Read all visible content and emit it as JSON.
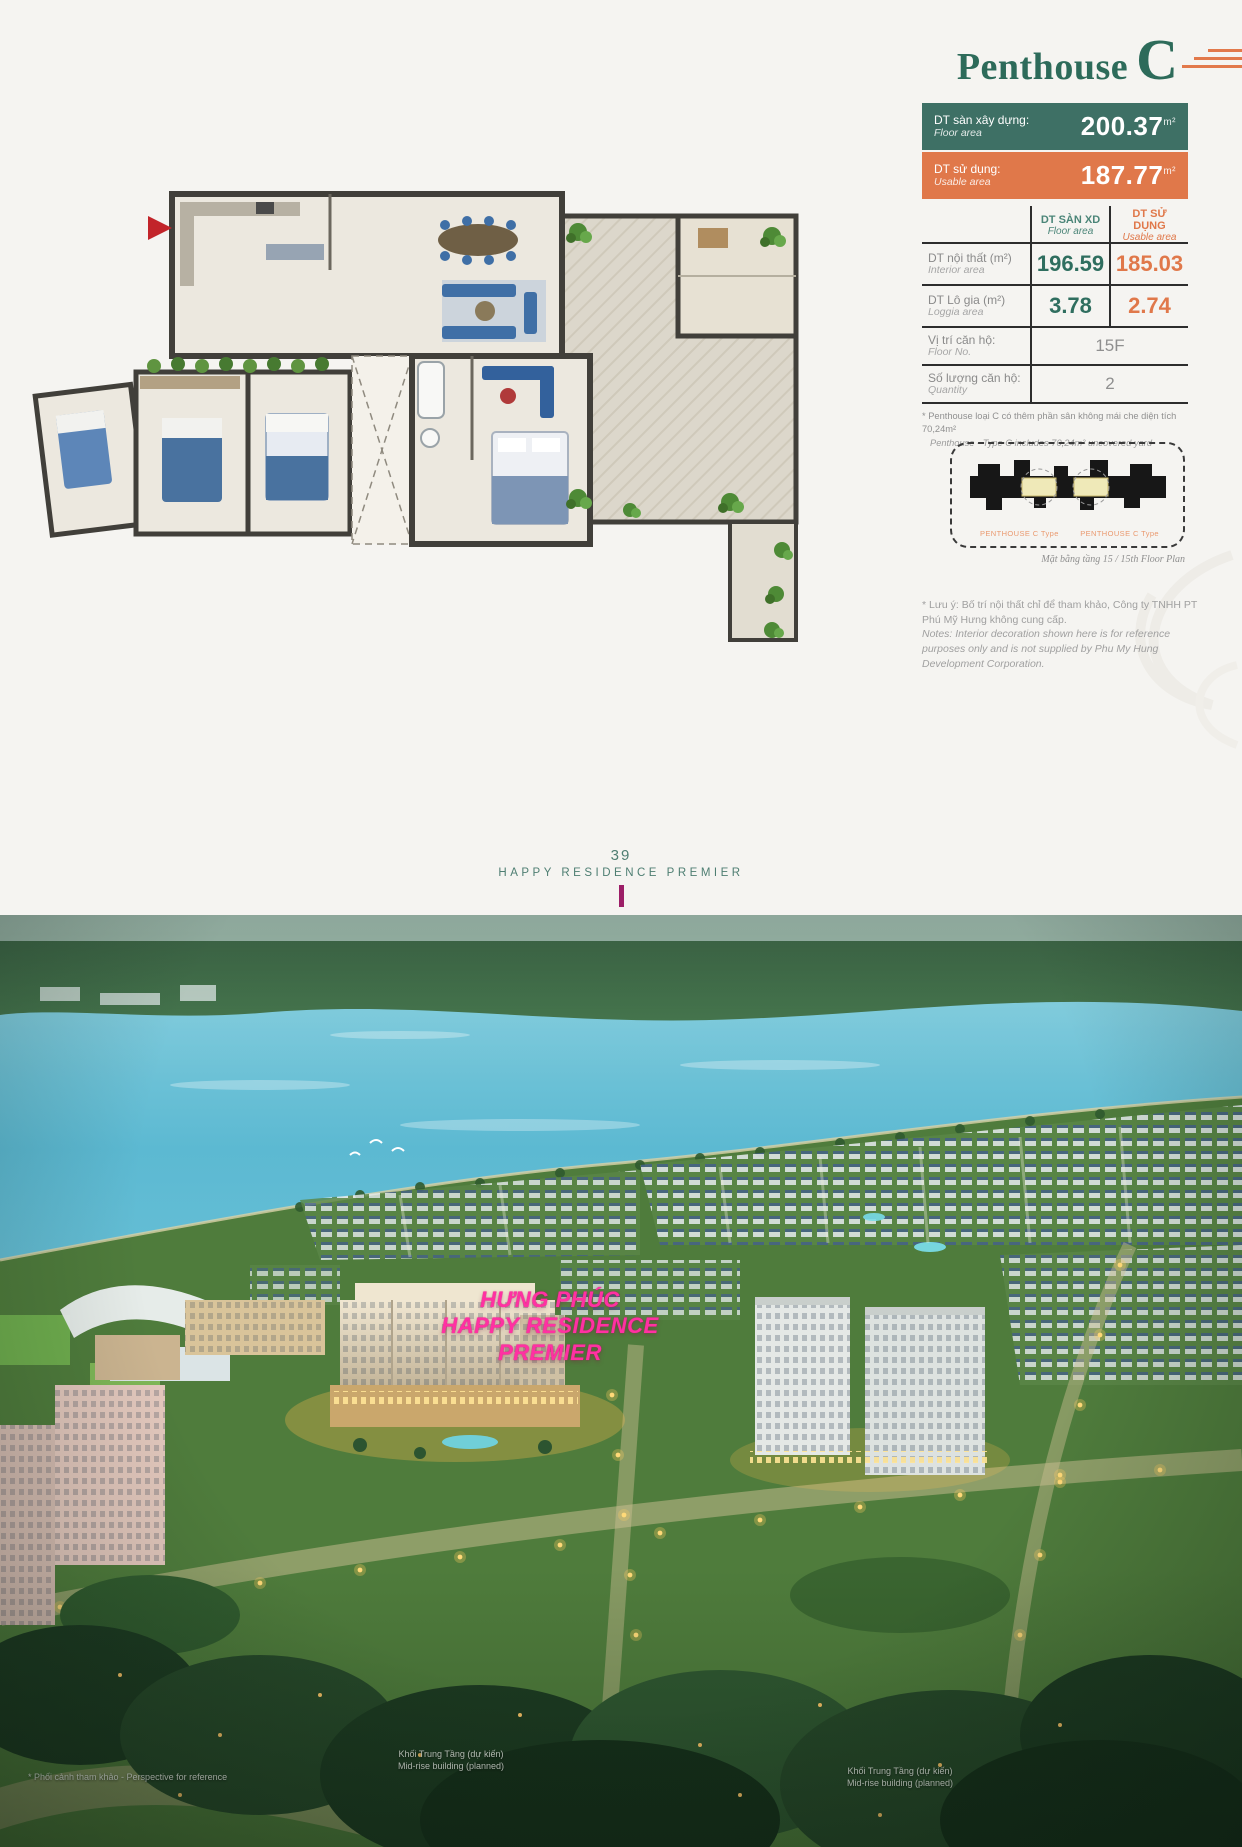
{
  "title": {
    "main": "Penthouse",
    "letter": "C"
  },
  "summary": {
    "floor": {
      "vi": "DT sàn xây dựng:",
      "en": "Floor area",
      "value": "200.37",
      "unit": "m²"
    },
    "usable": {
      "vi": "DT sử dụng:",
      "en": "Usable area",
      "value": "187.77",
      "unit": "m²"
    }
  },
  "table": {
    "headers": {
      "floor_vi": "DT SÀN XD",
      "floor_en": "Floor area",
      "usable_vi": "DT SỬ DỤNG",
      "usable_en": "Usable area"
    },
    "rows": [
      {
        "vi": "DT nội thất (m²)",
        "en": "Interior area",
        "floor": "196.59",
        "usable": "185.03"
      },
      {
        "vi": "DT Lô gia (m²)",
        "en": "Loggia area",
        "floor": "3.78",
        "usable": "2.74"
      }
    ],
    "info_rows": [
      {
        "vi": "Vị trí căn hộ:",
        "en": "Floor No.",
        "value": "15F"
      },
      {
        "vi": "Số lượng căn hộ:",
        "en": "Quantity",
        "value": "2"
      }
    ]
  },
  "footnote": {
    "vi": "* Penthouse loại C có thêm phần sân không mái che diện tích 70,24m²",
    "en": "Penthouse - Type C includes 70,24m² uncovered yard"
  },
  "keyplan": {
    "label_left": "PENTHOUSE C Type",
    "label_right": "PENTHOUSE C Type",
    "caption": "Mặt bằng tầng 15 / 15th Floor Plan"
  },
  "notes": {
    "line1": "* Lưu ý: Bố trí nội thất chỉ để tham khảo, Công ty TNHH PT",
    "line2": "Phú Mỹ Hưng không cung cấp.",
    "line3": "Notes: Interior decoration shown here is for reference",
    "line4": "purposes only and is not supplied by Phu My Hung",
    "line5": "Development Corporation."
  },
  "footer": {
    "page_number": "39",
    "brand": "HAPPY RESIDENCE PREMIER"
  },
  "photo": {
    "sign": {
      "line1": "HƯNG PHÚC",
      "line2": "HAPPY RESIDENCE",
      "line3": "PREMIER"
    },
    "captions": {
      "left": "* Phối cảnh tham khảo - Perspective for reference",
      "center_vi": "Khối Trung Tầng (dự kiến)",
      "center_en": "Mid-rise building (planned)",
      "right_vi": "Khối Trung Tầng (dự kiến)",
      "right_en": "Mid-rise building (planned)"
    }
  },
  "colors": {
    "teal": "#2f6e5f",
    "orange": "#e0784a",
    "accent_magenta": "#9c1e67",
    "sign_pink": "#ff31a2"
  }
}
